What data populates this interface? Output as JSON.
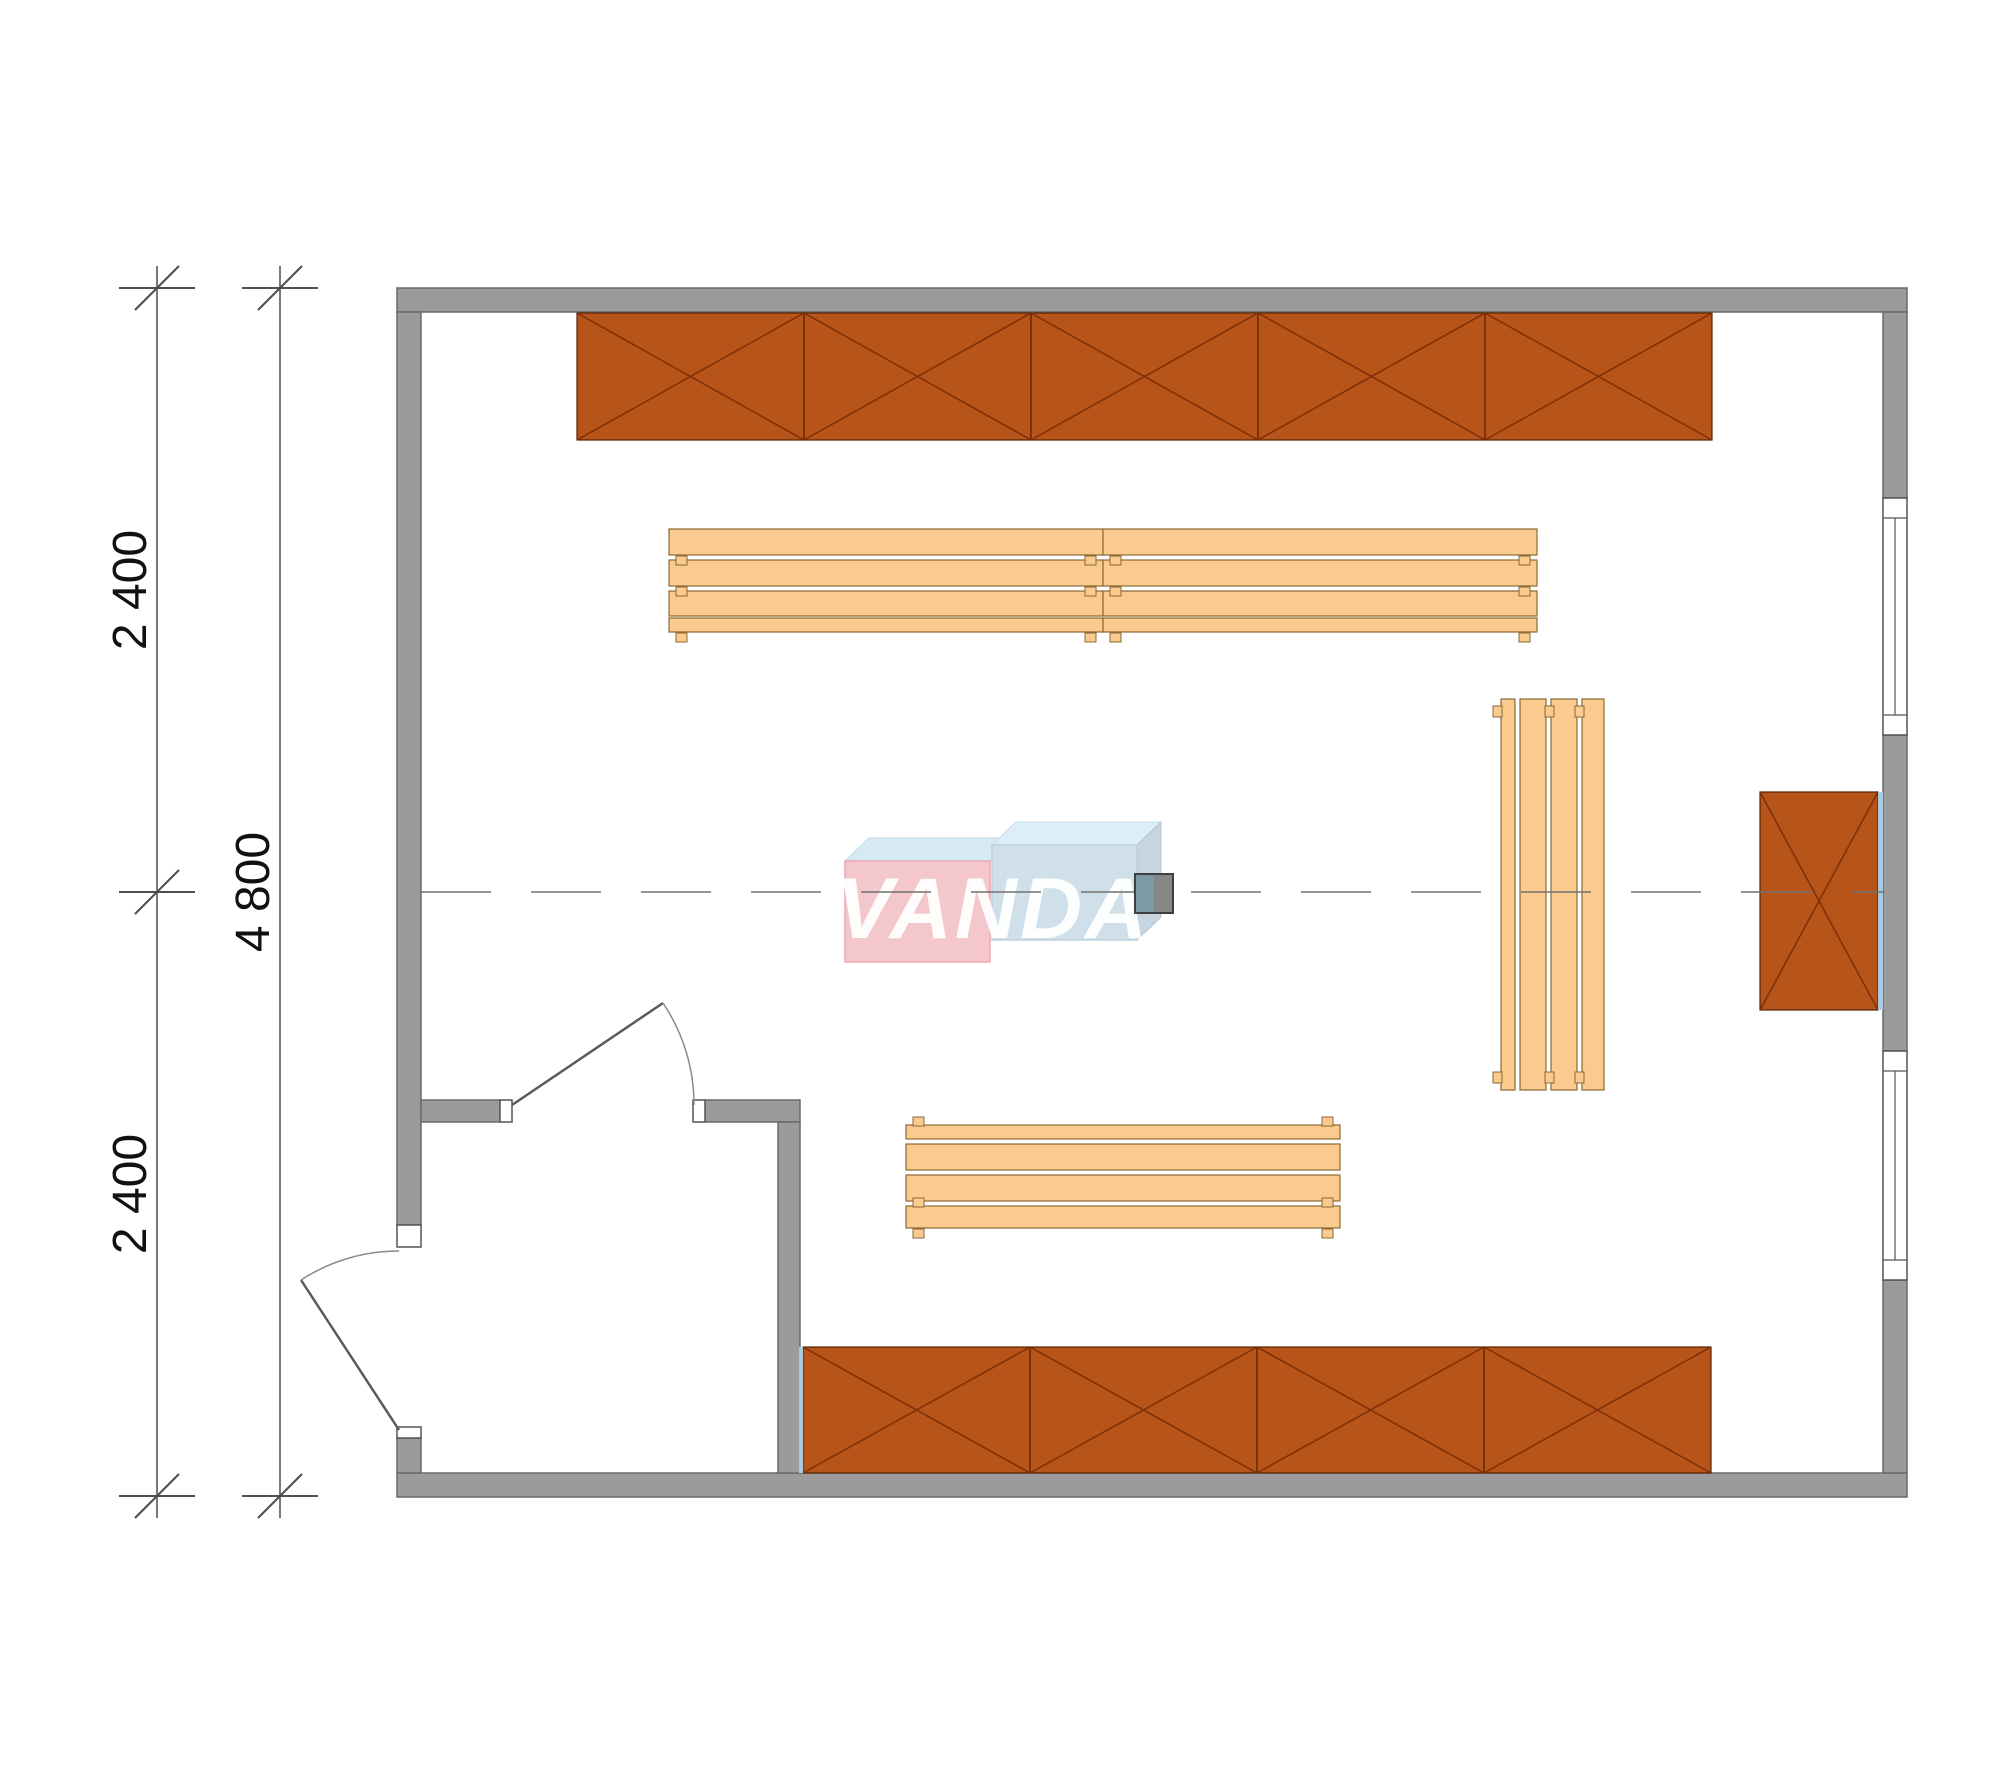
{
  "drawing": {
    "type": "architectural floor plan, top view"
  },
  "dimensions": {
    "chain_labels": [
      "2 400",
      "2 400"
    ],
    "total_label": "4 800"
  },
  "logo": {
    "text": "VANDA"
  },
  "colors": {
    "wall": "#9b9b9b",
    "wall-edge": "#6a6a6a",
    "cabinet": "#b75419",
    "cabinet-edge": "#5a2104",
    "cabinet-diag": "#7c2f08",
    "bench": "#fbca8f",
    "bench-edge": "#8a6a33",
    "accent": "#a9cbdd",
    "dim": "#4d4d4d",
    "centerline": "#707070",
    "door": "#5a5a5a",
    "logo-pink": "#f4c3c8",
    "logo-pink-edge": "#eaa2ab",
    "logo-blue": "#ccdeea",
    "logo-blue-top": "#d9edfa",
    "logo-blue-side": "#c2d2de",
    "logo-pink-top": "#d3e9f6",
    "marker-teal": "#7d99a3",
    "marker-gray": "#868686",
    "marker-edge": "#3f3f3f"
  },
  "furniture": {
    "slat_patterns": {
      "thin_end": [
        [
          0,
          26
        ],
        [
          31,
          26
        ],
        [
          62,
          25
        ],
        [
          89,
          14
        ]
      ],
      "thin_start": [
        [
          0,
          14
        ],
        [
          19,
          26
        ],
        [
          50,
          26
        ],
        [
          81,
          22
        ]
      ]
    },
    "cabinet_runs": [
      {
        "name": "cabinet-run-top",
        "x": 577,
        "y": 313,
        "panel_w": 227,
        "h": 127,
        "panels": 5,
        "accent": "none"
      },
      {
        "name": "cabinet-run-bottom",
        "x": 803,
        "y": 1347,
        "panel_w": 227,
        "h": 126,
        "panels": 4,
        "accent": "left"
      },
      {
        "name": "cabinet-right-wall",
        "x": 1760,
        "y": 792,
        "panel_w": 118,
        "h": 218,
        "panels": 1,
        "accent": "right"
      }
    ],
    "benches": [
      {
        "name": "bench-upper-left",
        "x": 669,
        "y": 529,
        "length": 434,
        "orient": "h",
        "pattern": "thin_end",
        "feet": [
          27,
          58,
          104
        ]
      },
      {
        "name": "bench-upper-right",
        "x": 1103,
        "y": 529,
        "length": 434,
        "orient": "h",
        "pattern": "thin_end",
        "feet": [
          27,
          58,
          104
        ]
      },
      {
        "name": "bench-lower",
        "x": 906,
        "y": 1125,
        "length": 434,
        "orient": "h",
        "pattern": "thin_start",
        "feet": [
          -8,
          73,
          104
        ]
      },
      {
        "name": "bench-right-vertical",
        "x": 1501,
        "y": 699,
        "length": 391,
        "orient": "v",
        "pattern": "thin_start",
        "feet": [
          -8,
          44,
          74
        ]
      }
    ]
  }
}
